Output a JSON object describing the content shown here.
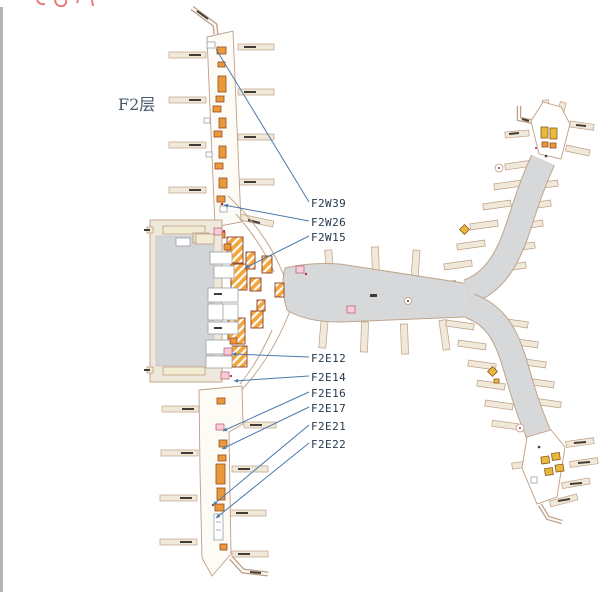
{
  "floor": {
    "label": "F2层"
  },
  "map": {
    "gate_labels": [
      {
        "text": "F2W39"
      },
      {
        "text": "F2W26"
      },
      {
        "text": "F2W15"
      },
      {
        "text": "F2E12"
      },
      {
        "text": "F2E14"
      },
      {
        "text": "F2E16"
      },
      {
        "text": "F2E17"
      },
      {
        "text": "F2E21"
      },
      {
        "text": "F2E22"
      }
    ],
    "colors": {
      "leader_line": "#4a7aa9",
      "label_text": "#26394e",
      "plan_outline": "#bf9e85",
      "concourse_fill": "#d6d8da",
      "bridge_fill": "#f0e9da",
      "shop_hatch": "#f2a73d",
      "shop_border": "#8a3a22",
      "highlight_pink": "#f6cdd8",
      "title_text": "#46566b",
      "clipped_header_text": "#e87a7a"
    }
  }
}
